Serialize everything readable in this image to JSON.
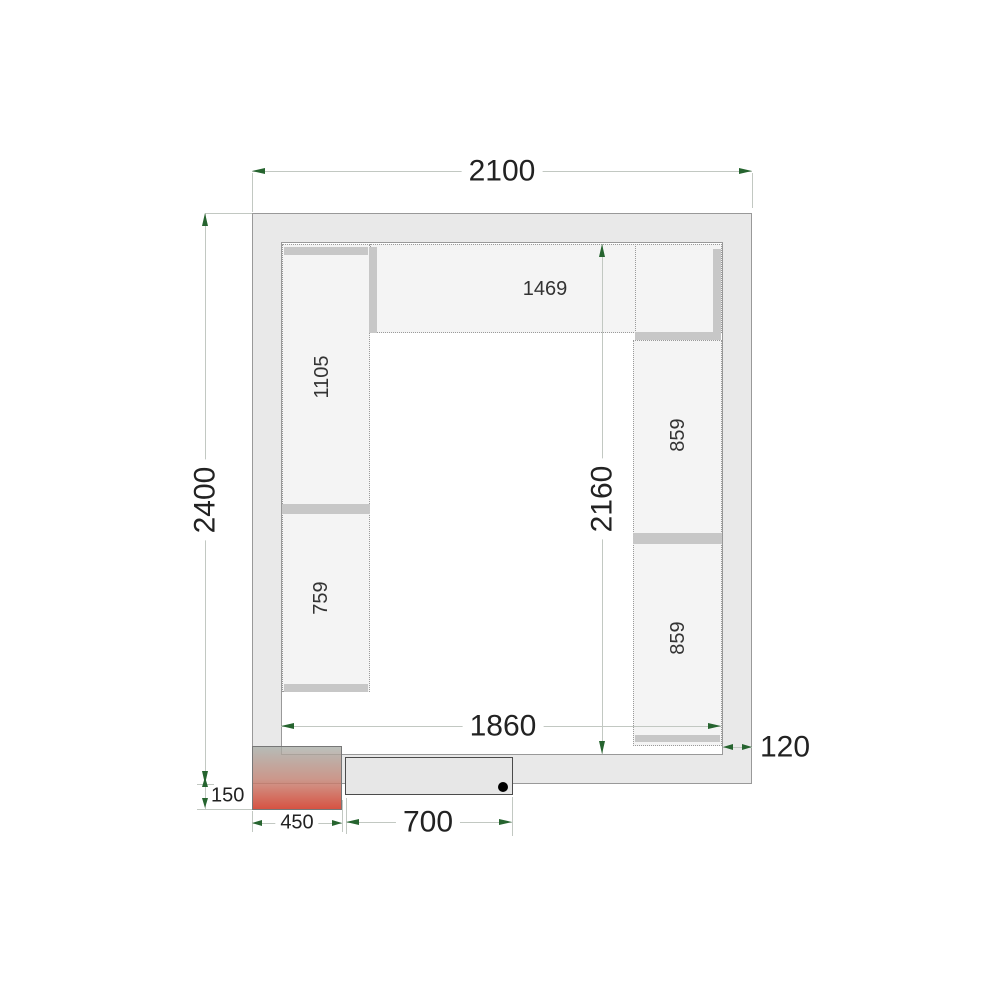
{
  "dims": {
    "outer_width": "2100",
    "outer_depth": "2400",
    "inner_depth": "2160",
    "inner_width": "1860",
    "wall_thickness": "120",
    "unit_offset": "150",
    "unit_width": "450",
    "door_width": "700"
  },
  "shelves": {
    "top": "1469",
    "left_upper": "1105",
    "left_lower": "759",
    "right_upper": "859",
    "right_lower": "859"
  },
  "colors": {
    "wall_fill": "#e9e9e9",
    "room_fill": "#ffffff",
    "shelf_fill": "#f4f4f4",
    "bar_fill": "#c7c7c7",
    "outline": "#999999",
    "dim_line": "#c2c8c2",
    "arrow": "#26642f",
    "text": "#222222",
    "door_outline": "#4b4b4b",
    "hinge_dot": "#000000",
    "unit_top": "#a8aea8",
    "unit_bottom": "#d2402e"
  }
}
